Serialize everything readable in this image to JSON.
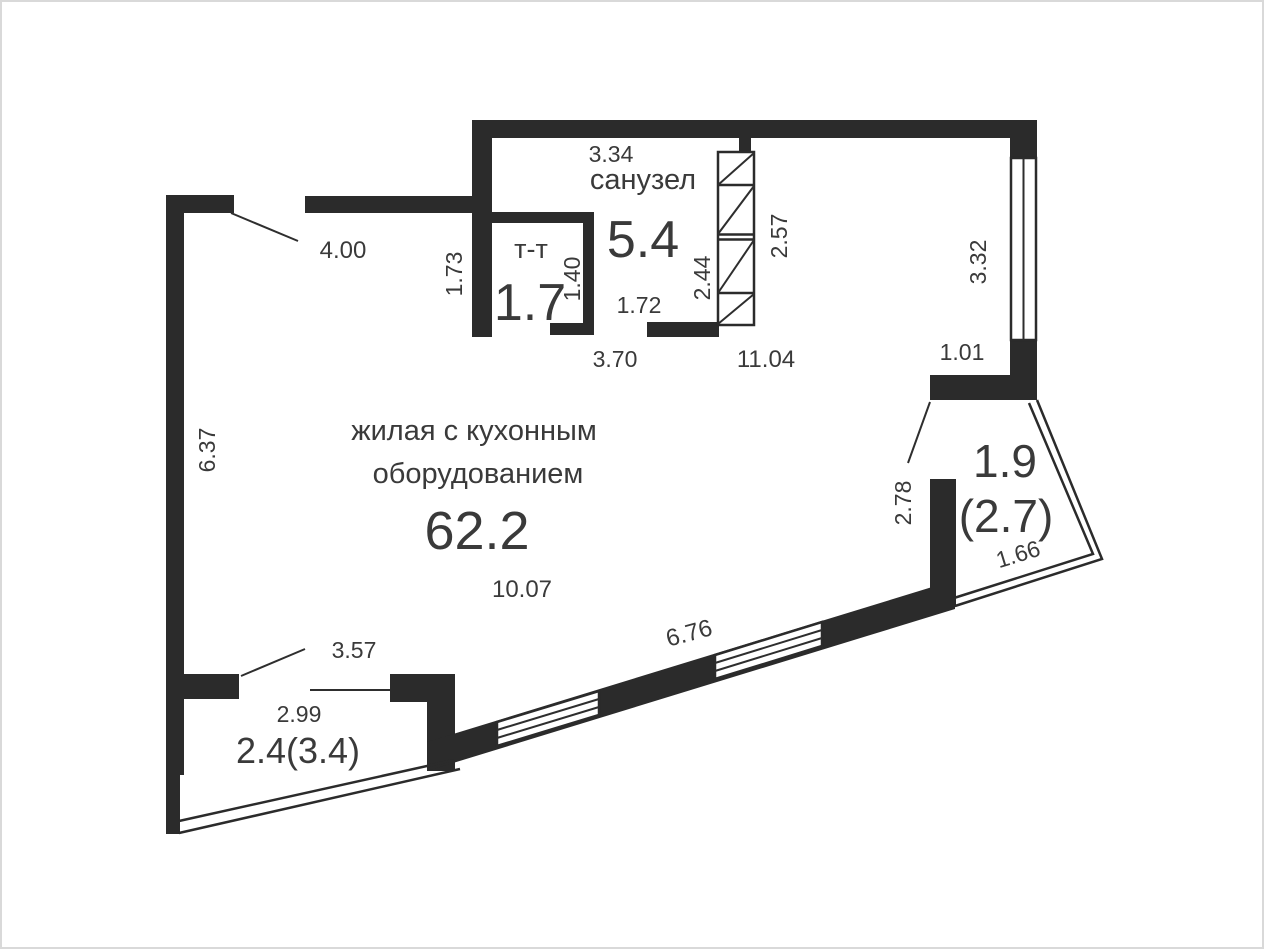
{
  "rooms": {
    "living": {
      "name_line1": "жилая с кухонным",
      "name_line2": "оборудованием",
      "area": "62.2"
    },
    "bathroom": {
      "name": "санузел",
      "area": "5.4"
    },
    "storage": {
      "name": "т-т",
      "area": "1.7"
    },
    "balcony_right": {
      "area": "1.9",
      "area_alt": "(2.7)"
    },
    "balcony_bottom": {
      "area": "2.4(3.4)"
    }
  },
  "dimensions": {
    "entry_wall": "4.00",
    "left_wall": "6.37",
    "corridor": "1.73",
    "storage_depth": "1.40",
    "bathroom_width": "3.34",
    "bathroom_bottom": "3.70",
    "bathroom_door": "1.72",
    "shaft_left": "2.44",
    "shaft_right": "2.57",
    "apartment_width": "11.04",
    "right_window": "3.32",
    "right_pier": "1.01",
    "living_width": "10.07",
    "sloped_window": "6.76",
    "balcony_right_door": "2.78",
    "balcony_right_edge": "1.66",
    "balcony_bottom_opening": "3.57",
    "balcony_bottom_width": "2.99"
  },
  "colors": {
    "wall": "#2b2b2b",
    "line": "#2e2e2e",
    "text": "#3a3a3a",
    "border": "#d9d9d9",
    "bg": "#ffffff"
  }
}
